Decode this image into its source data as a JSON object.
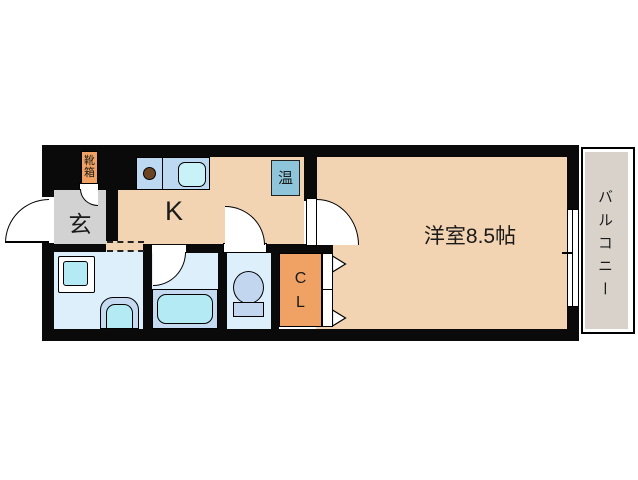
{
  "floorplan": {
    "labels": {
      "entrance": "玄",
      "kitchen": "K",
      "western_room": "洋室8.5帖",
      "balcony": "バルコニー",
      "water_heater": "温",
      "shoe_box_l1": "靴",
      "shoe_box_l2": "箱",
      "closet_l1": "C",
      "closet_l2": "L"
    },
    "colors": {
      "wall": "#0A0A0A",
      "floor_main": "#F2D3B2",
      "entrance_floor": "#D2D2D2",
      "wet_floor": "#DDEFFB",
      "panel_blue": "#C5DAF1",
      "cyan": "#B4EAF3",
      "counter_blue": "#BDD9F1",
      "sink_cyan": "#C9F1F8",
      "heater_blue": "#8FC5DA",
      "accent_orange": "#EFA263",
      "burner_brown": "#6B4423",
      "balcony_gray": "#D8D2CA",
      "toilet_blue": "#C3D6F0"
    }
  }
}
